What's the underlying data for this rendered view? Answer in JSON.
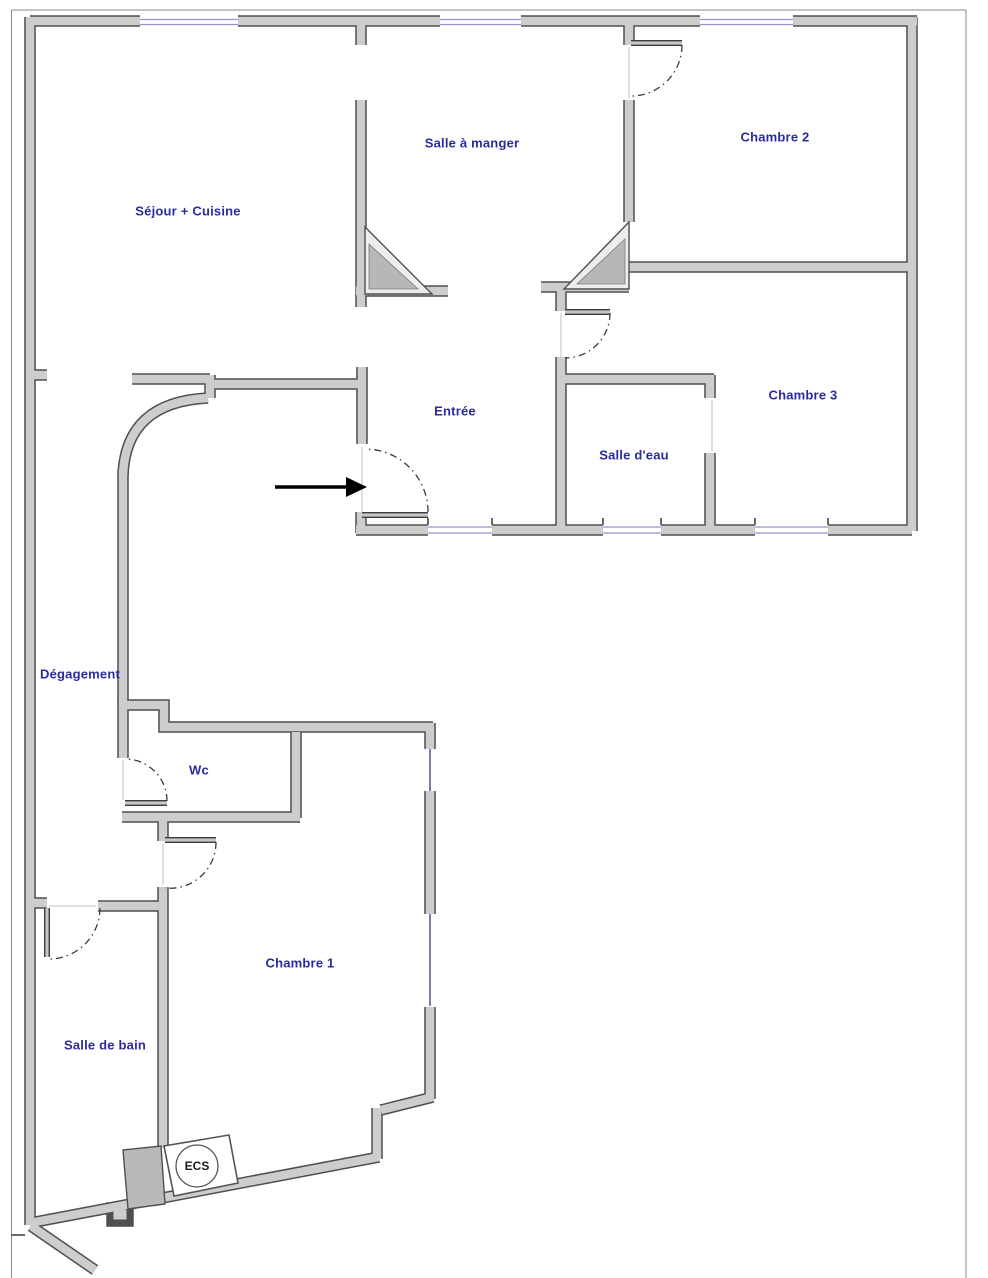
{
  "plan": {
    "type": "apartment-floor-plan",
    "rooms": [
      {
        "id": "sejour-cuisine",
        "label": "Séjour + Cuisine"
      },
      {
        "id": "salle-a-manger",
        "label": "Salle à manger"
      },
      {
        "id": "chambre-2",
        "label": "Chambre 2"
      },
      {
        "id": "entree",
        "label": "Entrée"
      },
      {
        "id": "chambre-3",
        "label": "Chambre 3"
      },
      {
        "id": "salle-deau",
        "label": "Salle d'eau"
      },
      {
        "id": "degagement",
        "label": "Dégagement"
      },
      {
        "id": "wc",
        "label": "Wc"
      },
      {
        "id": "chambre-1",
        "label": "Chambre 1"
      },
      {
        "id": "salle-de-bain",
        "label": "Salle de bain"
      }
    ],
    "equipment": {
      "ecs": "ECS"
    },
    "annotations": {
      "entrance_arrow": "arrow pointing right into entrance door"
    },
    "doors": [
      "entrance-door",
      "chambre-2-door",
      "hall-to-salle-deau-door",
      "chambre-3-opening",
      "wc-door",
      "chambre-1-door",
      "salle-de-bain-door"
    ],
    "windows": {
      "top_wall": 3,
      "south_wall_middle": 3,
      "chambre_1_east_wall": 2
    },
    "colors": {
      "label_color": "#2b2b9e",
      "wall_fill": "#cdcdcd",
      "wall_outline": "#4f4f4f",
      "window_blue": "#9494c6",
      "window_navy": "#5c5c9e",
      "arrow_color": "#000000"
    }
  }
}
